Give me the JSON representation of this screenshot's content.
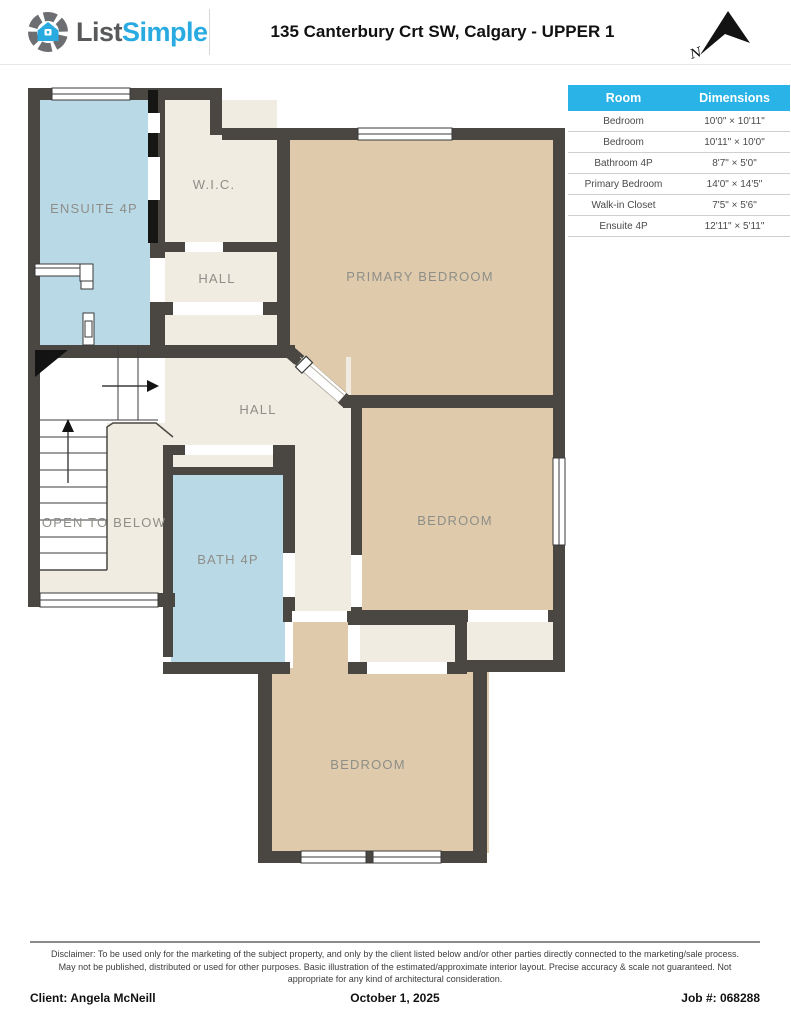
{
  "header": {
    "logo_gray": "List",
    "logo_blue": "Simple",
    "title": "135 Canterbury Crt SW, Calgary - UPPER 1",
    "north_label": "N"
  },
  "table": {
    "col_room": "Room",
    "col_dims": "Dimensions",
    "rows": [
      {
        "room": "Bedroom",
        "dims": "10'0\" × 10'11\""
      },
      {
        "room": "Bedroom",
        "dims": "10'11\" × 10'0\""
      },
      {
        "room": "Bathroom 4P",
        "dims": "8'7\" × 5'0\""
      },
      {
        "room": "Primary Bedroom",
        "dims": "14'0\" × 14'5\""
      },
      {
        "room": "Walk-in Closet",
        "dims": "7'5\" × 5'6\""
      },
      {
        "room": "Ensuite 4P",
        "dims": "12'11\" × 5'11\""
      }
    ]
  },
  "plan": {
    "labels": {
      "ensuite": "ENSUITE 4P",
      "wic": "W.I.C.",
      "hall_upper": "HALL",
      "primary": "PRIMARY BEDROOM",
      "hall_main": "HALL",
      "open_below": "OPEN TO BELOW",
      "bath": "BATH 4P",
      "bedroom_right": "BEDROOM",
      "bedroom_bottom": "BEDROOM"
    },
    "colors": {
      "wall": "#4a4742",
      "room_cream": "#f1ece2",
      "room_tan": "#dfcbac",
      "room_blue": "#bad9e7",
      "label": "#8e8e88"
    }
  },
  "footer": {
    "disclaimer": "Disclaimer: To be used only for the marketing of the subject property, and only by the client listed below and/or other parties directly connected to the marketing/sale process. May not be published, distributed or used for other purposes. Basic illustration of the estimated/approximate interior layout. Precise accuracy & scale not guaranteed. Not appropriate for any kind of architectural consideration.",
    "client": "Client: Angela McNeill",
    "date": "October 1, 2025",
    "job": "Job #: 068288"
  }
}
